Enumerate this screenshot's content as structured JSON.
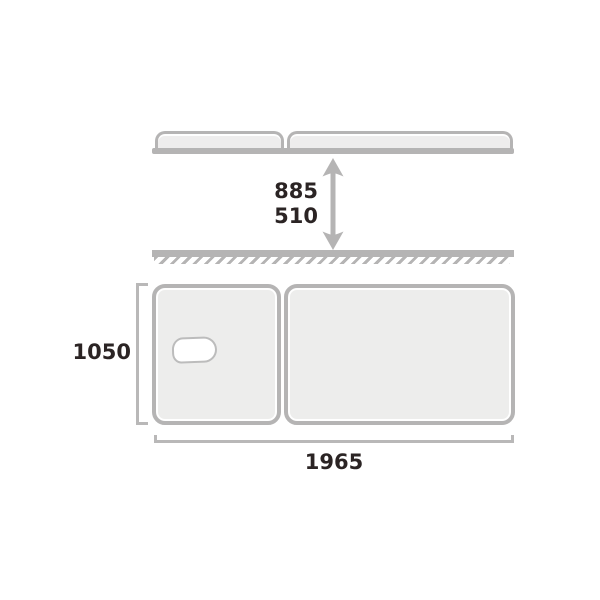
{
  "diagram": {
    "type": "product-dimension-diagram",
    "subject": "two-section-treatment-table",
    "height_dimension": {
      "max": "885",
      "min": "510"
    },
    "width_dimension": {
      "value": "1050"
    },
    "length_dimension": {
      "value": "1965"
    },
    "icons": [
      "height-range-arrow-icon",
      "face-hole-icon",
      "floor-hatch-icon"
    ],
    "colors": {
      "background": "#ffffff",
      "outline_gray": "#b5b4b4",
      "bracket_gray": "#b9b8b8",
      "surface_fill": "#ededec",
      "hole_fill": "#ffffff",
      "text": "#2b2424"
    }
  }
}
